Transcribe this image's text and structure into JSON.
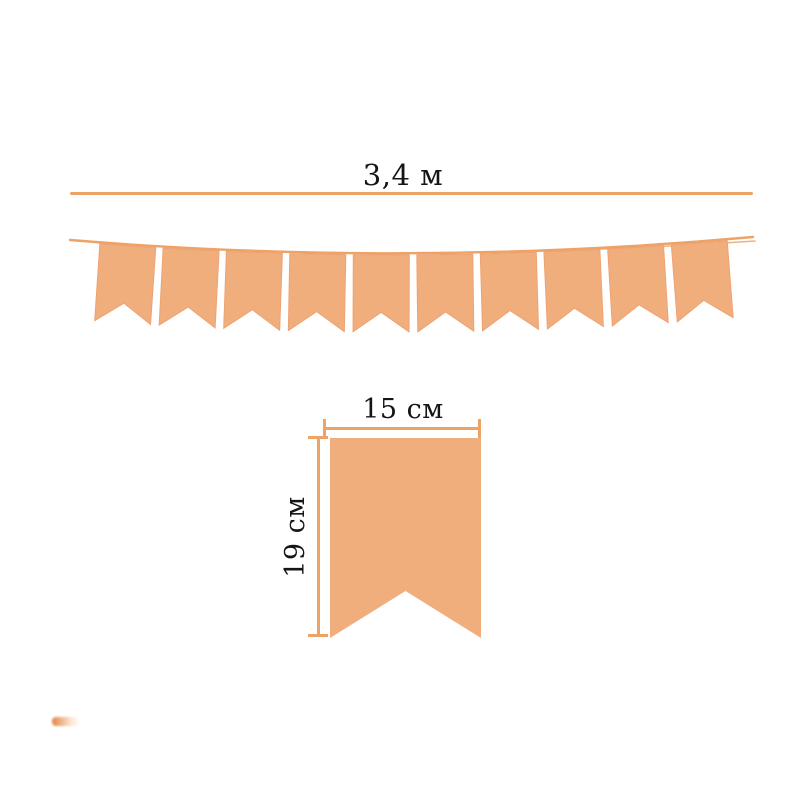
{
  "diagram": {
    "kind": "pennant-banner-dimensions"
  },
  "labels": {
    "total_length": "3,4 м",
    "flag_width": "15 см",
    "flag_height": "19 см"
  },
  "banner": {
    "flag_count": 10,
    "flag_shape": "swallowtail-pennant"
  },
  "colors": {
    "background": "#ffffff",
    "flag_fill": "#f1ae7d",
    "flag_edge": "#eea273",
    "line": "#eda266",
    "text": "#151515"
  }
}
